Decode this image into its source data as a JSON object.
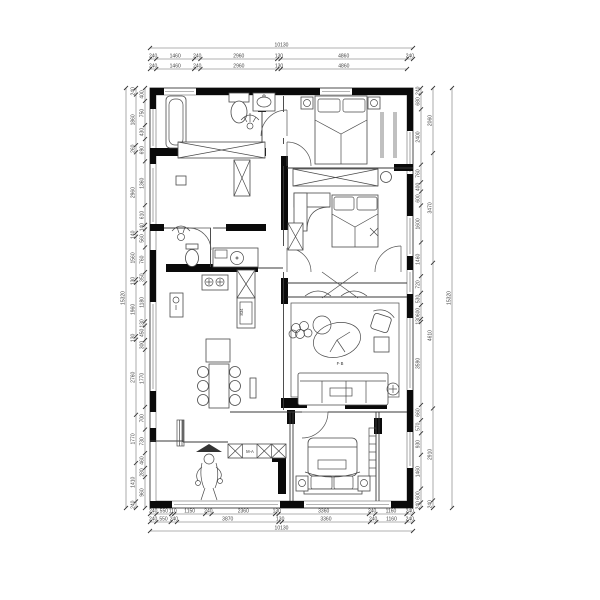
{
  "drawing": {
    "labels": {
      "living_room": "F·B",
      "cabinet_depth": "834",
      "shoe_cabinet": "M-A"
    },
    "dims": {
      "top_total": [
        "10130"
      ],
      "top_row1": [
        "240",
        "1460",
        "240",
        "2960",
        "130",
        "4860",
        "240"
      ],
      "top_row2": [
        "240",
        "1460",
        "240",
        "2960",
        "130",
        "4860"
      ],
      "bottom_row1": [
        "240",
        "550",
        "110",
        "1150",
        "240",
        "2360",
        "130",
        "3360",
        "240",
        "1160",
        "240"
      ],
      "bottom_row2": [
        "240",
        "550",
        "240",
        "3870",
        "130",
        "3360",
        "240",
        "1160",
        "240"
      ],
      "bottom_total": [
        "10130"
      ],
      "left_total": [
        "15320"
      ],
      "left_outer": [
        "240",
        "1860",
        "260",
        "2960",
        "140",
        "1560",
        "130",
        "1960",
        "130",
        "2760",
        "1770",
        "1410",
        "240"
      ],
      "left_inner": [
        "400",
        "750",
        "430",
        "690",
        "1360",
        "610",
        "140",
        "560",
        "760",
        "350",
        "1180",
        "130",
        "450",
        "300",
        "1770",
        "700",
        "730",
        "460",
        "280",
        "960"
      ],
      "right_total": [
        "15320"
      ],
      "right_outer": [
        "2060",
        "3470",
        "4610",
        "2910",
        "240"
      ],
      "right_inner": [
        "240",
        "680",
        "2400",
        "760",
        "400",
        "600",
        "1600",
        "1460",
        "720",
        "530",
        "600",
        "130",
        "3590",
        "660",
        "570",
        "930",
        "1460",
        "600",
        "240"
      ]
    }
  }
}
